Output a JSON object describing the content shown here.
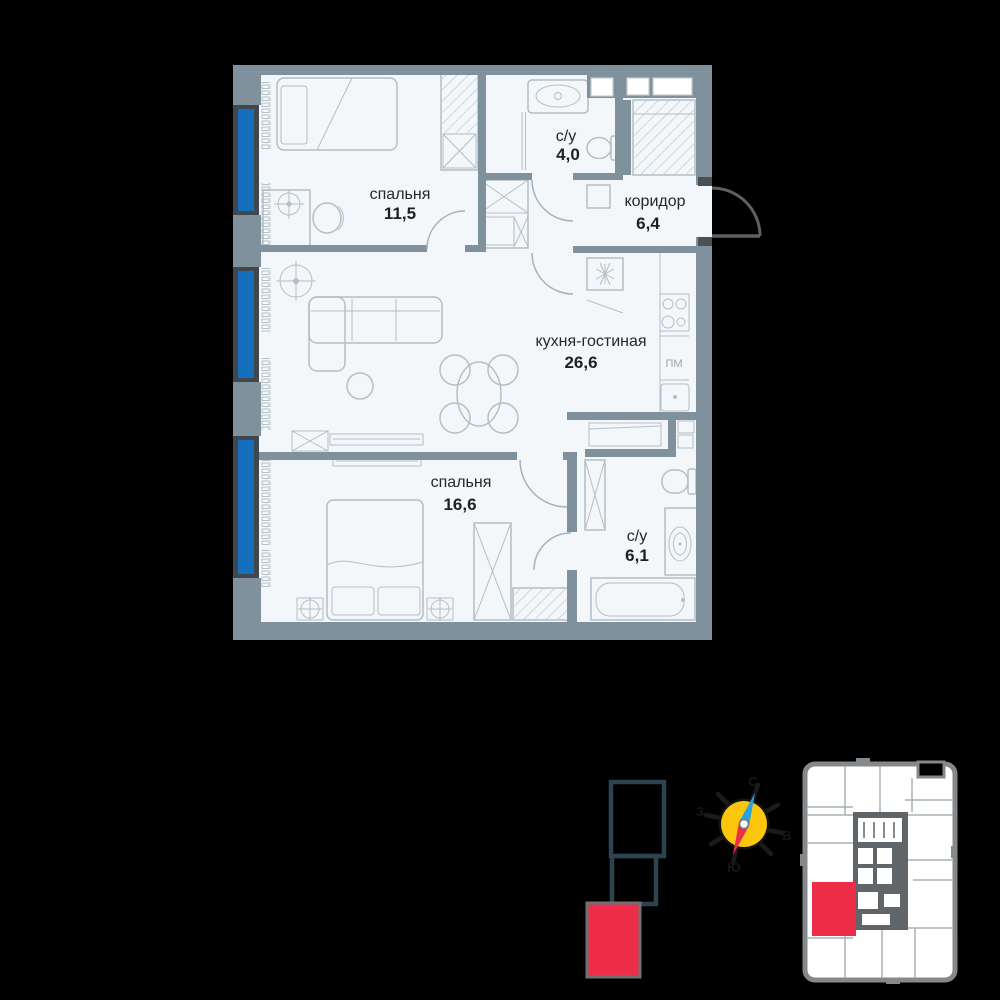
{
  "plan": {
    "rooms": [
      {
        "name": "спальня",
        "area": "11,5"
      },
      {
        "name": "с/у",
        "area": "4,0"
      },
      {
        "name": "коридор",
        "area": "6,4"
      },
      {
        "name": "кухня-гостиная",
        "area": "26,6"
      },
      {
        "name": "спальня",
        "area": "16,6"
      },
      {
        "name": "с/у",
        "area": "6,1"
      }
    ],
    "appliances": {
      "dishwasher_label": "ПМ"
    }
  },
  "compass": {
    "north": "С",
    "south": "Ю",
    "west": "З",
    "east": "В"
  },
  "colors": {
    "background": "#000000",
    "floor": "#f3f7f9",
    "wall": "#7e919c",
    "window_blue": "#1470bd",
    "accent_red": "#ee2e49",
    "compass_yellow": "#fcc60d",
    "needle_blue": "#2aa3dd",
    "silhouette_outline": "#2c4350",
    "furniture_line": "#b4bec6"
  }
}
